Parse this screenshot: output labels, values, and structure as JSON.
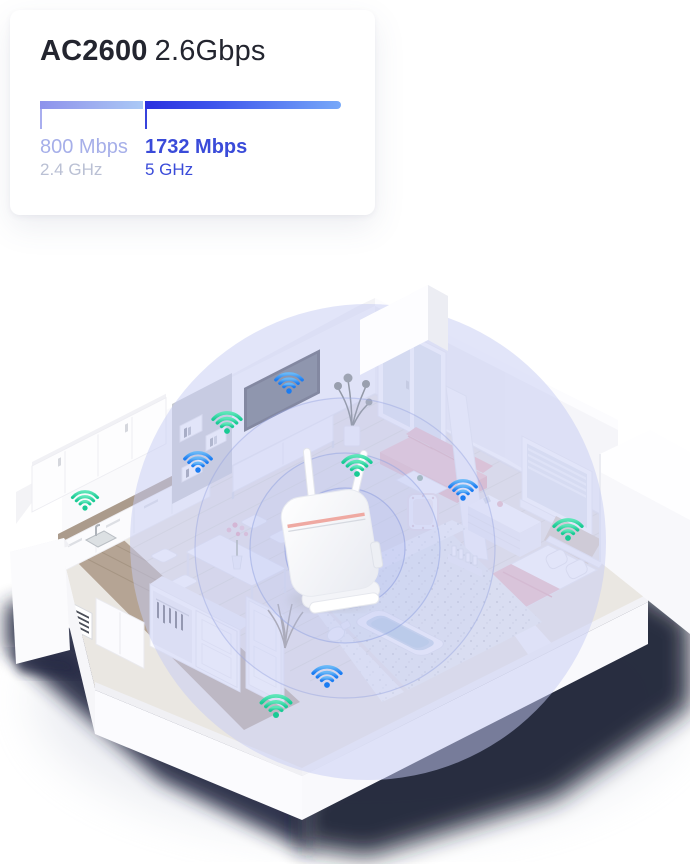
{
  "page": {
    "background": "#ffffff"
  },
  "card": {
    "title_bold": "AC2600",
    "title_regular": "2.6Gbps",
    "bands": [
      {
        "speed": "800 Mbps",
        "freq": "2.4 GHz",
        "bar_width": "103px",
        "bar_gradient_start": "#8D92EC",
        "bar_gradient_end": "#AAC9F6",
        "speed_color": "#A6AFE9",
        "freq_color": "#BAC0D4"
      },
      {
        "speed": "1732 Mbps",
        "freq": "5 GHz",
        "bar_width": "196px",
        "bar_gradient_start": "#2B30DF",
        "bar_gradient_end": "#77A9F9",
        "speed_color": "#3A4BD9",
        "freq_color": "#3A4BD9"
      }
    ]
  },
  "scene": {
    "description": "isometric apartment cutaway showing wifi router coverage",
    "coverage_color": "#C5CBF4",
    "ring_color": "#96A5E1",
    "shadow_color": "#20243A",
    "router": {
      "name": "router-device",
      "stripe_color": "#EFA9A2"
    },
    "wifi_bands": {
      "green": {
        "start": "#5CE6B8",
        "end": "#19CA94"
      },
      "blue": {
        "start": "#66B7F8",
        "end": "#1B7CF2"
      }
    },
    "wifi_points": [
      {
        "name": "wifi-living-tv",
        "band": "blue"
      },
      {
        "name": "wifi-shelf-top",
        "band": "green"
      },
      {
        "name": "wifi-shelf-bottom",
        "band": "blue"
      },
      {
        "name": "wifi-kitchen",
        "band": "green"
      },
      {
        "name": "wifi-router-side",
        "band": "green"
      },
      {
        "name": "wifi-bedroom-wall",
        "band": "blue"
      },
      {
        "name": "wifi-window-nook",
        "band": "green"
      },
      {
        "name": "wifi-bathroom",
        "band": "blue"
      },
      {
        "name": "wifi-hallway",
        "band": "green"
      }
    ]
  }
}
